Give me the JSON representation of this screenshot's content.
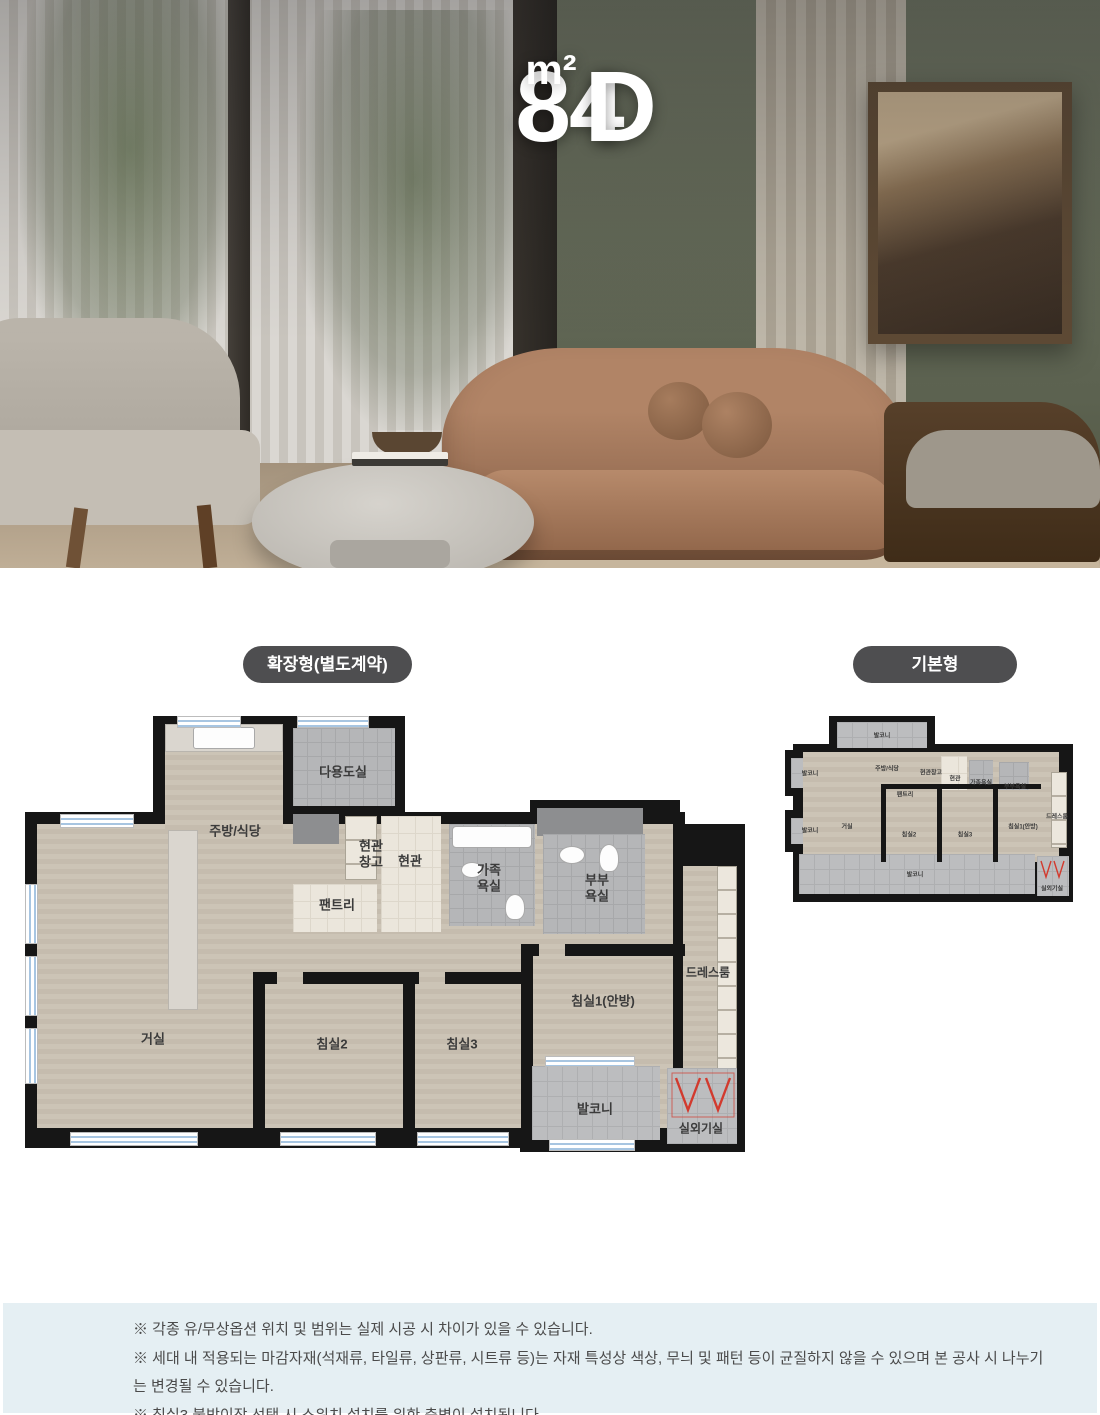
{
  "hero": {
    "title_number": "84",
    "title_unit": "m²",
    "title_letter": "D"
  },
  "summary": {
    "households": "55세대",
    "areas": [
      "전용면적 : 84.9452m²",
      "공급면적 : 111.2559m²",
      "계약면적 : 173.8065m²"
    ],
    "separator": "|"
  },
  "plans": {
    "extended_badge": "확장형(별도계약)",
    "basic_badge": "기본형",
    "rooms": {
      "utility": "다용도실",
      "kitchen": "주방/식당",
      "entry_storage": "현관창고",
      "entry": "현관",
      "family_bath": "가족욕실",
      "master_bath": "부부욕실",
      "pantry": "팬트리",
      "dress_room": "드레스룸",
      "bedroom1": "침실1(안방)",
      "living": "거실",
      "bedroom2": "침실2",
      "bedroom3": "침실3",
      "balcony": "발코니",
      "ac_room": "실외기실"
    }
  },
  "notes": [
    "※ 각종 유/무상옵션 위치 및 범위는 실제 시공 시 차이가 있을 수 있습니다.",
    "※ 세대 내 적용되는 마감자재(석재류, 타일류, 상판류, 시트류 등)는 자재 특성상 색상, 무늬 및 패턴 등이 균질하지 않을 수 있으며 본 공사 시 나누기는 변경될 수 있습니다.",
    "※ 침실3 붙박이장 선택 시 스위치 설치를 위한 측벽이 설치됩니다."
  ],
  "colors": {
    "navy": "#1b3247",
    "badge_gray": "#4e4e50",
    "notes_bg": "#e5eff3",
    "ac_mark_red": "#d23a2e"
  }
}
